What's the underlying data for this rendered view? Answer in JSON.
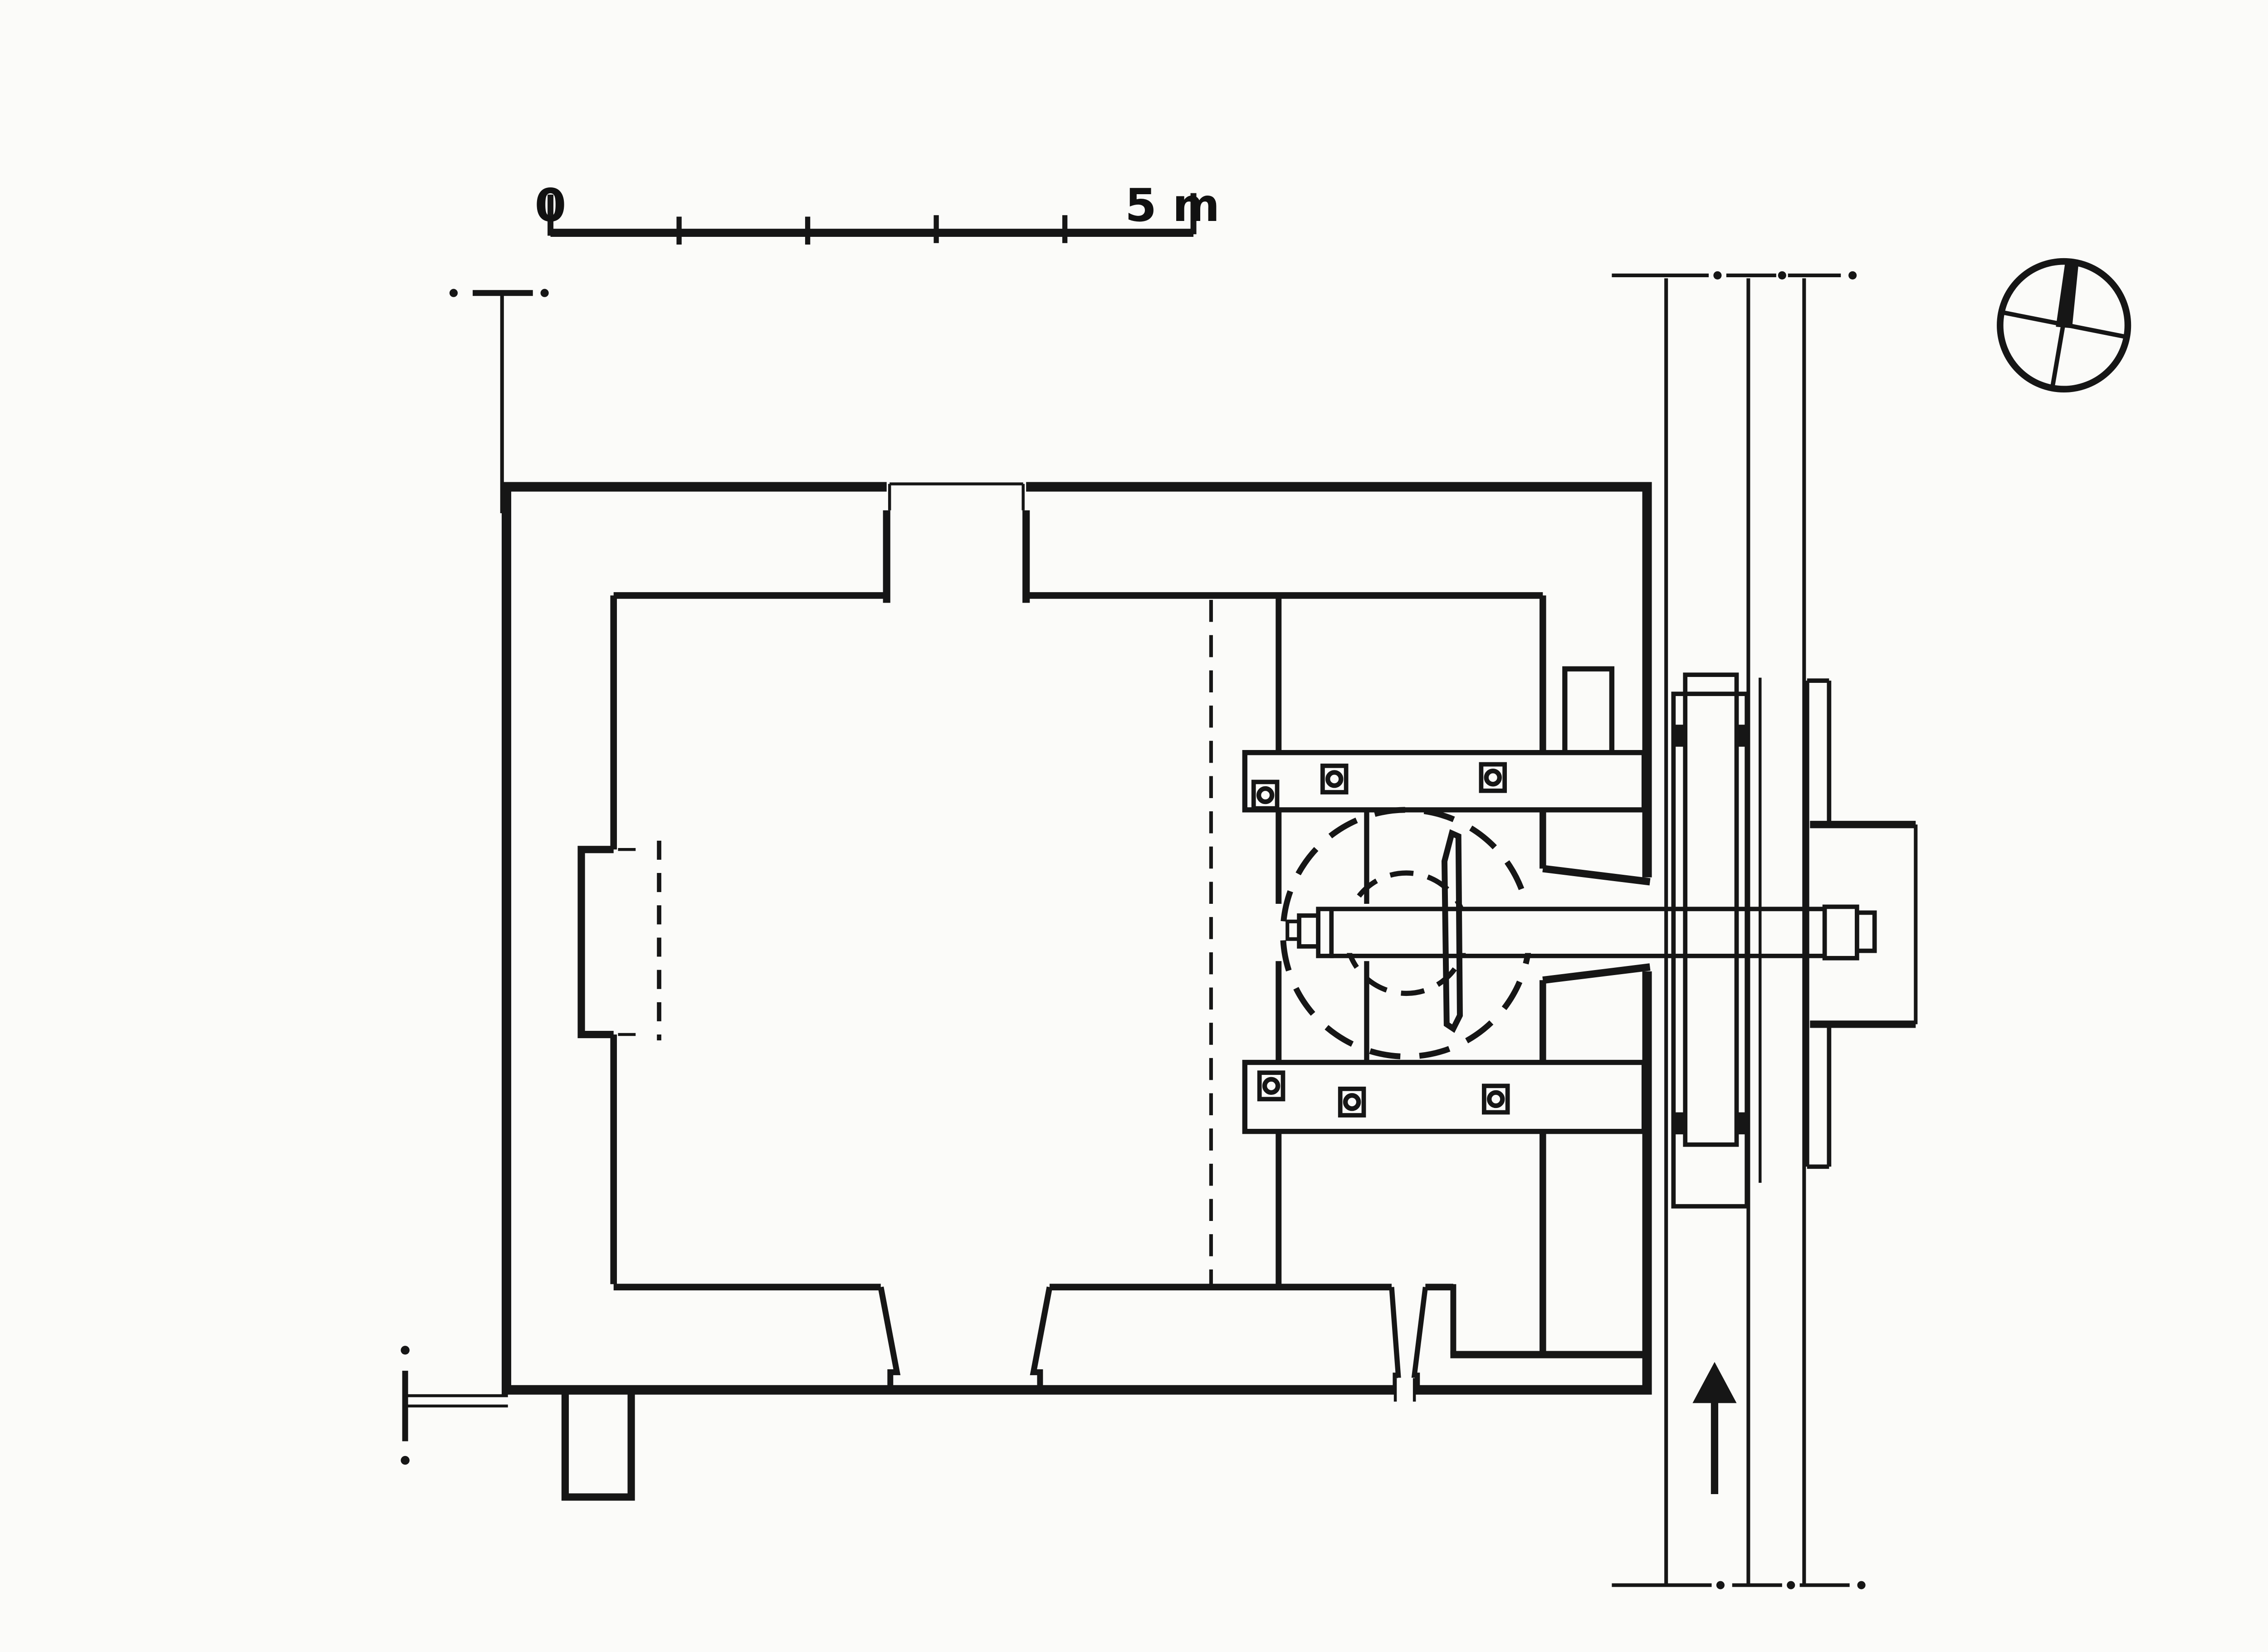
{
  "drawing": {
    "kind": "scanned watermill ground-plan (measured survey drawing)",
    "paper_color": "#fbfbf9",
    "ink_color": "#161616"
  },
  "scale_bar": {
    "zero_label": "0",
    "end_label": "5 m",
    "divisions": 5,
    "division_unit_m": 1
  },
  "compass": {
    "icon": "north-compass-icon",
    "style": "circle with tilted cross, solid wedge pointing north"
  },
  "stream": {
    "channel_line_count": 3,
    "flow_icon": "flow-direction-arrow-icon",
    "flow_direction": "up (north)",
    "cut_line_style": "dash-dot at both ends"
  },
  "plan_features": {
    "outer_wall": "thick rectangular enclosure with north porch opening, east axle slot, south drain slot",
    "inner_room": "thick-walled inner chamber with dashed overhead line, west window niche, two splayed south doorways",
    "wheel_chamber": "east compartment with top and bottom bearing beams",
    "bearing_bolts_per_beam": 3,
    "gear_circles": "two concentric dashed circles (pit wheel) around axle",
    "axle": "horizontal shaft from inner room through east wall, across race to bearing plate",
    "water_wheel": "tall narrow double rectangle in race with four bearing pads",
    "survey_markers": "dash-dot station marks top-left and bottom-left",
    "buttress": "small rectangular projection on south wall near west corner"
  }
}
